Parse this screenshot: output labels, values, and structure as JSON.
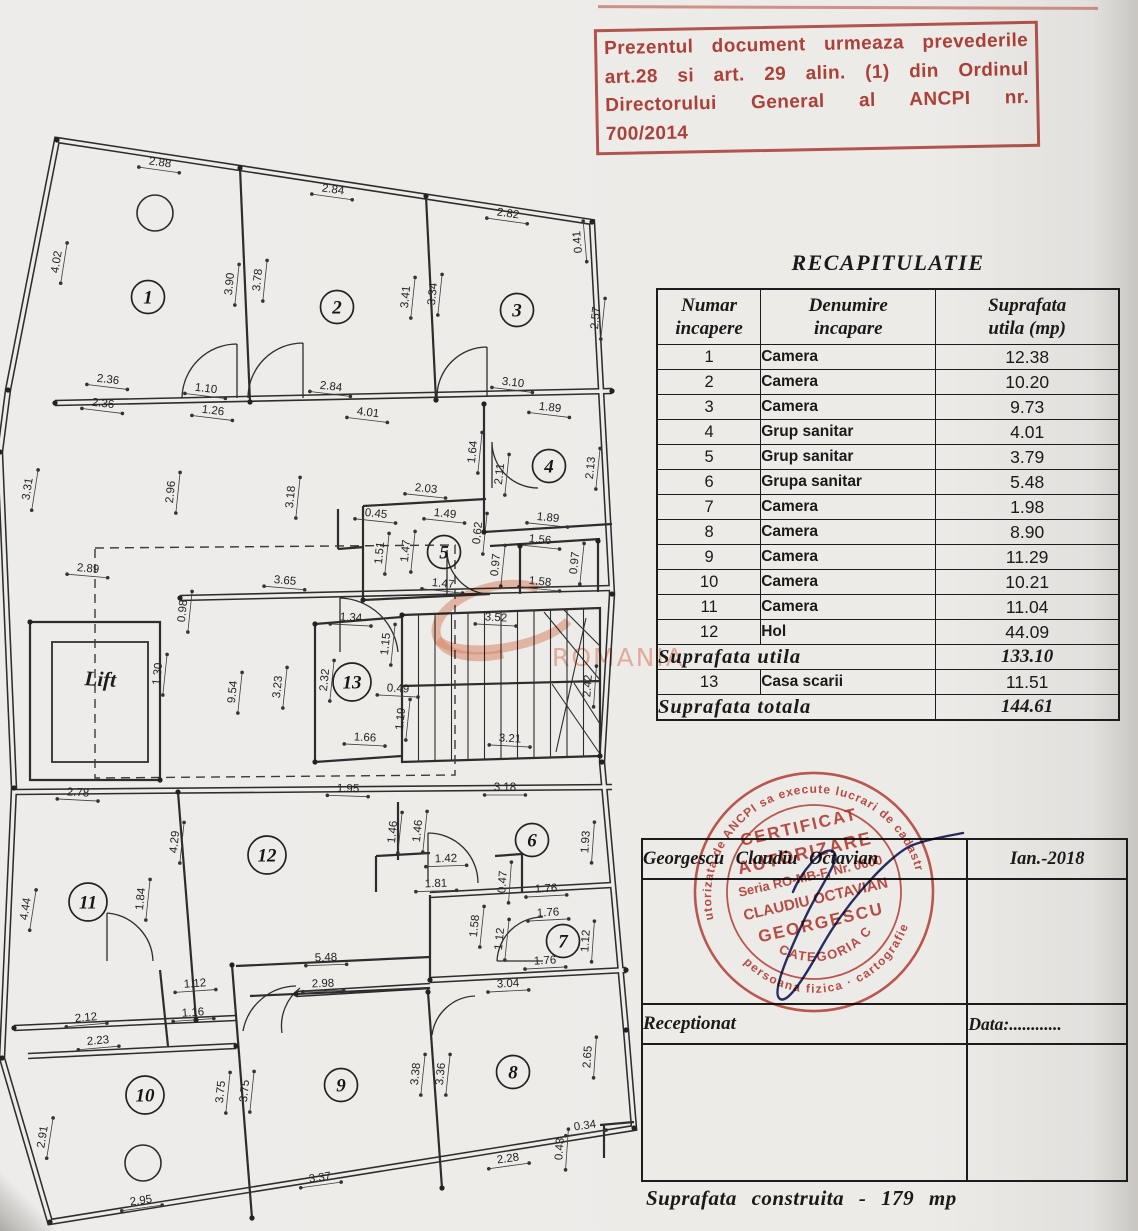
{
  "top_stamp": {
    "line1": "Prezentul document urmeaza prevederile",
    "line2": "art.28 si art. 29 alin. (1) din Ordinul",
    "line3": "Directorului General al ANCPI nr.",
    "line4": "700/2014"
  },
  "recap": {
    "title": "RECAPITULATIE",
    "col1_l1": "Numar",
    "col1_l2": "incapere",
    "col2_l1": "Denumire",
    "col2_l2": "incapare",
    "col3_l1": "Suprafata",
    "col3_l2": "utila  (mp)",
    "rows": [
      {
        "num": "1",
        "name": "Camera",
        "area": "12.38"
      },
      {
        "num": "2",
        "name": "Camera",
        "area": "10.20"
      },
      {
        "num": "3",
        "name": "Camera",
        "area": "9.73"
      },
      {
        "num": "4",
        "name": "Grup sanitar",
        "area": "4.01"
      },
      {
        "num": "5",
        "name": "Grup sanitar",
        "area": "3.79"
      },
      {
        "num": "6",
        "name": "Grupa sanitar",
        "area": "5.48"
      },
      {
        "num": "7",
        "name": "Camera",
        "area": "1.98"
      },
      {
        "num": "8",
        "name": "Camera",
        "area": "8.90"
      },
      {
        "num": "9",
        "name": "Camera",
        "area": "11.29"
      },
      {
        "num": "10",
        "name": "Camera",
        "area": "10.21"
      },
      {
        "num": "11",
        "name": "Camera",
        "area": "11.04"
      },
      {
        "num": "12",
        "name": "Hol",
        "area": "44.09"
      }
    ],
    "subtotal_label": "Suprafata utila",
    "subtotal_value": "133.10",
    "extra_row": {
      "num": "13",
      "name": "Casa scarii",
      "area": "11.51"
    },
    "total_label": "Suprafata totala",
    "total_value": "144.61"
  },
  "sign_table": {
    "surveyor_name": "Georgescu Claudiu Octavian",
    "date": "Ian.-2018",
    "receptionat_label": "Receptionat",
    "data_label": "Data:............"
  },
  "round_stamp": {
    "ring_top": "autorizata de ANCPI sa execute lucrari de cadastru",
    "ring_bottom": "persoana fizica · cartografie",
    "line1": "CERTIFICAT",
    "line2": "AUTORIZARE",
    "line3": "Seria RO-MB-F, Nr. 0600",
    "line4": "CLAUDIU OCTAVIAN",
    "line5": "GEORGESCU",
    "line6": "CATEGORIA C"
  },
  "footer": {
    "built_area": "Suprafata construita - 179 mp"
  },
  "watermark": {
    "text": "ROMANIA"
  },
  "colors": {
    "stamp_red": "#b2362e",
    "ink": "#1c1c1c",
    "pen_blue": "#28306b",
    "watermark_orange": "#e99071"
  },
  "plan": {
    "lift_label": "Lift",
    "rooms": [
      {
        "n": "1",
        "x": 148,
        "y": 297
      },
      {
        "n": "2",
        "x": 337,
        "y": 307
      },
      {
        "n": "3",
        "x": 517,
        "y": 310
      },
      {
        "n": "4",
        "x": 549,
        "y": 466
      },
      {
        "n": "5",
        "x": 444,
        "y": 552
      },
      {
        "n": "6",
        "x": 532,
        "y": 840
      },
      {
        "n": "7",
        "x": 563,
        "y": 941
      },
      {
        "n": "8",
        "x": 513,
        "y": 1072
      },
      {
        "n": "9",
        "x": 341,
        "y": 1085
      },
      {
        "n": "10",
        "x": 145,
        "y": 1095
      },
      {
        "n": "11",
        "x": 88,
        "y": 902
      },
      {
        "n": "12",
        "x": 267,
        "y": 855
      },
      {
        "n": "13",
        "x": 352,
        "y": 682
      }
    ],
    "dims": [
      {
        "t": "2.88",
        "x": 160,
        "y": 163,
        "r": 8
      },
      {
        "t": "2.84",
        "x": 333,
        "y": 190,
        "r": 8
      },
      {
        "t": "2.82",
        "x": 508,
        "y": 214,
        "r": 8
      },
      {
        "t": "0.41",
        "x": 578,
        "y": 242,
        "r": -95
      },
      {
        "t": "4.02",
        "x": 57,
        "y": 262,
        "r": -81
      },
      {
        "t": "3.90",
        "x": 230,
        "y": 284,
        "r": -84
      },
      {
        "t": "3.78",
        "x": 258,
        "y": 280,
        "r": -84
      },
      {
        "t": "3.41",
        "x": 406,
        "y": 297,
        "r": -84
      },
      {
        "t": "3.34",
        "x": 433,
        "y": 294,
        "r": -84
      },
      {
        "t": "2.57",
        "x": 596,
        "y": 318,
        "r": -84
      },
      {
        "t": "2.36",
        "x": 108,
        "y": 380,
        "r": 7
      },
      {
        "t": "1.10",
        "x": 206,
        "y": 389,
        "r": 7
      },
      {
        "t": "2.36",
        "x": 103,
        "y": 404,
        "r": 7
      },
      {
        "t": "1.26",
        "x": 213,
        "y": 411,
        "r": 7
      },
      {
        "t": "2.84",
        "x": 331,
        "y": 387,
        "r": 7
      },
      {
        "t": "4.01",
        "x": 368,
        "y": 413,
        "r": 7
      },
      {
        "t": "3.10",
        "x": 513,
        "y": 383,
        "r": 7
      },
      {
        "t": "1.89",
        "x": 550,
        "y": 408,
        "r": 7
      },
      {
        "t": "1.64",
        "x": 473,
        "y": 452,
        "r": -84
      },
      {
        "t": "2.11",
        "x": 500,
        "y": 474,
        "r": -84
      },
      {
        "t": "2.13",
        "x": 591,
        "y": 468,
        "r": -84
      },
      {
        "t": "2.03",
        "x": 426,
        "y": 489,
        "r": 6
      },
      {
        "t": "1.49",
        "x": 445,
        "y": 514,
        "r": 6
      },
      {
        "t": "0.45",
        "x": 376,
        "y": 514,
        "r": 6
      },
      {
        "t": "1.51",
        "x": 380,
        "y": 553,
        "r": -84
      },
      {
        "t": "1.47",
        "x": 406,
        "y": 551,
        "r": -84
      },
      {
        "t": "1.47",
        "x": 443,
        "y": 584,
        "r": 6
      },
      {
        "t": "0.62",
        "x": 478,
        "y": 533,
        "r": -84
      },
      {
        "t": "1.56",
        "x": 540,
        "y": 540,
        "r": 6
      },
      {
        "t": "0.97",
        "x": 496,
        "y": 565,
        "r": -84
      },
      {
        "t": "0.97",
        "x": 575,
        "y": 563,
        "r": -84
      },
      {
        "t": "1.58",
        "x": 540,
        "y": 582,
        "r": 6
      },
      {
        "t": "1.89",
        "x": 548,
        "y": 518,
        "r": 6
      },
      {
        "t": "2.89",
        "x": 88,
        "y": 569,
        "r": 5
      },
      {
        "t": "3.31",
        "x": 28,
        "y": 489,
        "r": -81
      },
      {
        "t": "2.96",
        "x": 171,
        "y": 492,
        "r": -84
      },
      {
        "t": "3.18",
        "x": 291,
        "y": 497,
        "r": -84
      },
      {
        "t": "0.98",
        "x": 183,
        "y": 611,
        "r": -84
      },
      {
        "t": "9.54",
        "x": 233,
        "y": 692,
        "r": -84
      },
      {
        "t": "3.23",
        "x": 278,
        "y": 687,
        "r": -84
      },
      {
        "t": "2.32",
        "x": 325,
        "y": 680,
        "r": -84
      },
      {
        "t": "3.65",
        "x": 285,
        "y": 581,
        "r": 5
      },
      {
        "t": "1.30",
        "x": 158,
        "y": 674,
        "r": -84
      },
      {
        "t": "1.34",
        "x": 351,
        "y": 618,
        "r": 3
      },
      {
        "t": "1.15",
        "x": 386,
        "y": 644,
        "r": -84
      },
      {
        "t": "3.52",
        "x": 496,
        "y": 618,
        "r": 3
      },
      {
        "t": "0.49",
        "x": 398,
        "y": 689,
        "r": 3
      },
      {
        "t": "1.19",
        "x": 401,
        "y": 719,
        "r": -84
      },
      {
        "t": "1.66",
        "x": 365,
        "y": 738,
        "r": 3
      },
      {
        "t": "3.21",
        "x": 510,
        "y": 739,
        "r": 3
      },
      {
        "t": "2.42",
        "x": 588,
        "y": 686,
        "r": -86
      },
      {
        "t": "1.95",
        "x": 348,
        "y": 789,
        "r": 2
      },
      {
        "t": "3.18",
        "x": 505,
        "y": 788,
        "r": 0
      },
      {
        "t": "2.78",
        "x": 78,
        "y": 793,
        "r": 3
      },
      {
        "t": "4.29",
        "x": 175,
        "y": 842,
        "r": -84
      },
      {
        "t": "4.44",
        "x": 26,
        "y": 909,
        "r": -81
      },
      {
        "t": "1.84",
        "x": 141,
        "y": 899,
        "r": -84
      },
      {
        "t": "1.46",
        "x": 393,
        "y": 832,
        "r": -84
      },
      {
        "t": "1.46",
        "x": 418,
        "y": 831,
        "r": -84
      },
      {
        "t": "1.42",
        "x": 446,
        "y": 859,
        "r": -2
      },
      {
        "t": "1.81",
        "x": 436,
        "y": 884,
        "r": -2
      },
      {
        "t": "1.93",
        "x": 586,
        "y": 842,
        "r": -86
      },
      {
        "t": "0.47",
        "x": 503,
        "y": 882,
        "r": -86
      },
      {
        "t": "1.76",
        "x": 546,
        "y": 889,
        "r": -3
      },
      {
        "t": "1.76",
        "x": 548,
        "y": 913,
        "r": -3
      },
      {
        "t": "1.58",
        "x": 475,
        "y": 926,
        "r": -84
      },
      {
        "t": "1.12",
        "x": 500,
        "y": 939,
        "r": -84
      },
      {
        "t": "1.12",
        "x": 586,
        "y": 941,
        "r": -86
      },
      {
        "t": "1.76",
        "x": 545,
        "y": 961,
        "r": -3
      },
      {
        "t": "3.04",
        "x": 508,
        "y": 984,
        "r": -3
      },
      {
        "t": "5.48",
        "x": 326,
        "y": 958,
        "r": -2
      },
      {
        "t": "2.98",
        "x": 323,
        "y": 984,
        "r": -2
      },
      {
        "t": "1.12",
        "x": 195,
        "y": 984,
        "r": -4
      },
      {
        "t": "1.16",
        "x": 193,
        "y": 1013,
        "r": -4
      },
      {
        "t": "2.12",
        "x": 86,
        "y": 1018,
        "r": -5
      },
      {
        "t": "2.23",
        "x": 98,
        "y": 1041,
        "r": -5
      },
      {
        "t": "2.95",
        "x": 141,
        "y": 1201,
        "r": -8
      },
      {
        "t": "3.37",
        "x": 320,
        "y": 1178,
        "r": -8
      },
      {
        "t": "2.28",
        "x": 508,
        "y": 1159,
        "r": -8
      },
      {
        "t": "0.34",
        "x": 585,
        "y": 1126,
        "r": -8
      },
      {
        "t": "0.43",
        "x": 560,
        "y": 1149,
        "r": -86
      },
      {
        "t": "2.65",
        "x": 588,
        "y": 1057,
        "r": -86
      },
      {
        "t": "3.38",
        "x": 416,
        "y": 1074,
        "r": -84
      },
      {
        "t": "3.36",
        "x": 441,
        "y": 1074,
        "r": -84
      },
      {
        "t": "3.75",
        "x": 221,
        "y": 1092,
        "r": -84
      },
      {
        "t": "3.75",
        "x": 245,
        "y": 1091,
        "r": -84
      },
      {
        "t": "2.91",
        "x": 43,
        "y": 1137,
        "r": -81
      }
    ]
  }
}
